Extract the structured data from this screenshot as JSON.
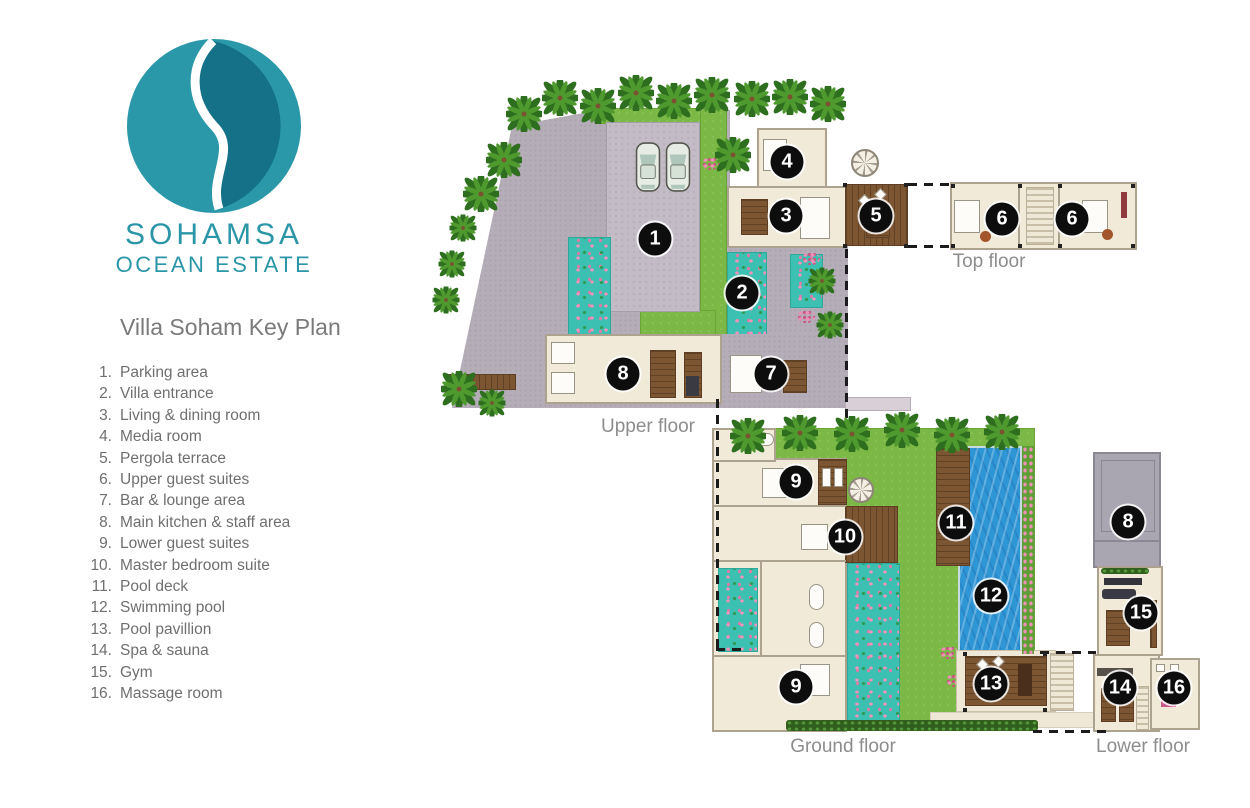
{
  "brand": {
    "line1": "SOHAMSA",
    "line2": "OCEAN ESTATE",
    "logo_colors": {
      "light_teal": "#2B98A9",
      "dark_teal": "#147187",
      "text_teal": "#2B96A7"
    }
  },
  "page_title": "Villa Soham Key Plan",
  "legend": {
    "items": [
      {
        "n": "1",
        "label": "Parking area"
      },
      {
        "n": "2",
        "label": "Villa entrance"
      },
      {
        "n": "3",
        "label": "Living & dining room"
      },
      {
        "n": "4",
        "label": "Media room"
      },
      {
        "n": "5",
        "label": "Pergola terrace"
      },
      {
        "n": "6",
        "label": "Upper guest suites"
      },
      {
        "n": "7",
        "label": "Bar & lounge area"
      },
      {
        "n": "8",
        "label": "Main kitchen & staff area"
      },
      {
        "n": "9",
        "label": "Lower guest suites"
      },
      {
        "n": "10",
        "label": "Master bedroom suite"
      },
      {
        "n": "11",
        "label": "Pool deck"
      },
      {
        "n": "12",
        "label": "Swimming pool"
      },
      {
        "n": "13",
        "label": "Pool pavillion"
      },
      {
        "n": "14",
        "label": "Spa & sauna"
      },
      {
        "n": "15",
        "label": "Gym"
      },
      {
        "n": "16",
        "label": "Massage room"
      }
    ]
  },
  "floors": [
    {
      "id": "upper",
      "label": "Upper floor",
      "markers": [
        {
          "n": "1",
          "x": 655,
          "y": 239
        },
        {
          "n": "2",
          "x": 742,
          "y": 293
        },
        {
          "n": "3",
          "x": 786,
          "y": 216
        },
        {
          "n": "4",
          "x": 787,
          "y": 162
        },
        {
          "n": "5",
          "x": 876,
          "y": 216
        },
        {
          "n": "7",
          "x": 771,
          "y": 374
        },
        {
          "n": "8",
          "x": 623,
          "y": 374
        }
      ]
    },
    {
      "id": "top",
      "label": "Top floor",
      "markers": [
        {
          "n": "6",
          "x": 1002,
          "y": 219
        },
        {
          "n": "6",
          "x": 1072,
          "y": 219
        }
      ]
    },
    {
      "id": "ground",
      "label": "Ground floor",
      "markers": [
        {
          "n": "9",
          "x": 796,
          "y": 482
        },
        {
          "n": "10",
          "x": 845,
          "y": 537
        },
        {
          "n": "11",
          "x": 956,
          "y": 523
        },
        {
          "n": "12",
          "x": 991,
          "y": 596
        },
        {
          "n": "13",
          "x": 991,
          "y": 684
        },
        {
          "n": "9",
          "x": 796,
          "y": 687
        }
      ]
    },
    {
      "id": "lower",
      "label": "Lower floor",
      "markers": [
        {
          "n": "8",
          "x": 1128,
          "y": 522
        },
        {
          "n": "15",
          "x": 1141,
          "y": 613
        },
        {
          "n": "14",
          "x": 1120,
          "y": 688
        },
        {
          "n": "16",
          "x": 1174,
          "y": 688
        }
      ]
    }
  ],
  "colors": {
    "marker": "#0D0D0D",
    "paving_gray": "#B5AEB8",
    "lawn_green": "#7CB845",
    "garden_teal": "#3BC0B1",
    "room_beige": "#F1EAD9",
    "deck_wood": "#7C5532",
    "pool_blue": "#2F96D6",
    "roof_gray": "#A9A5B1",
    "label_gray": "#8D8D8D"
  }
}
